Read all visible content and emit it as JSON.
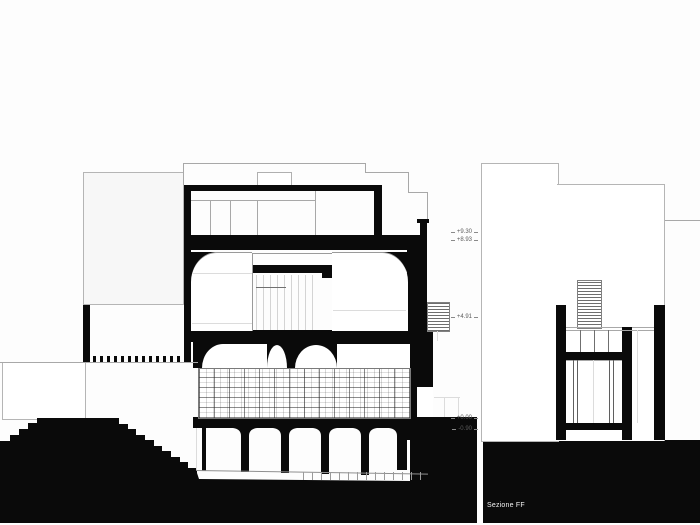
{
  "drawing": {
    "caption": "Sezione FF",
    "levels": [
      "+9.30",
      "+8.93",
      "+4.91",
      "+0.00",
      "-0.90"
    ],
    "colors": {
      "ink": "#0a0a0a",
      "line": "#a8a8a8",
      "background": "#ffffff"
    }
  }
}
